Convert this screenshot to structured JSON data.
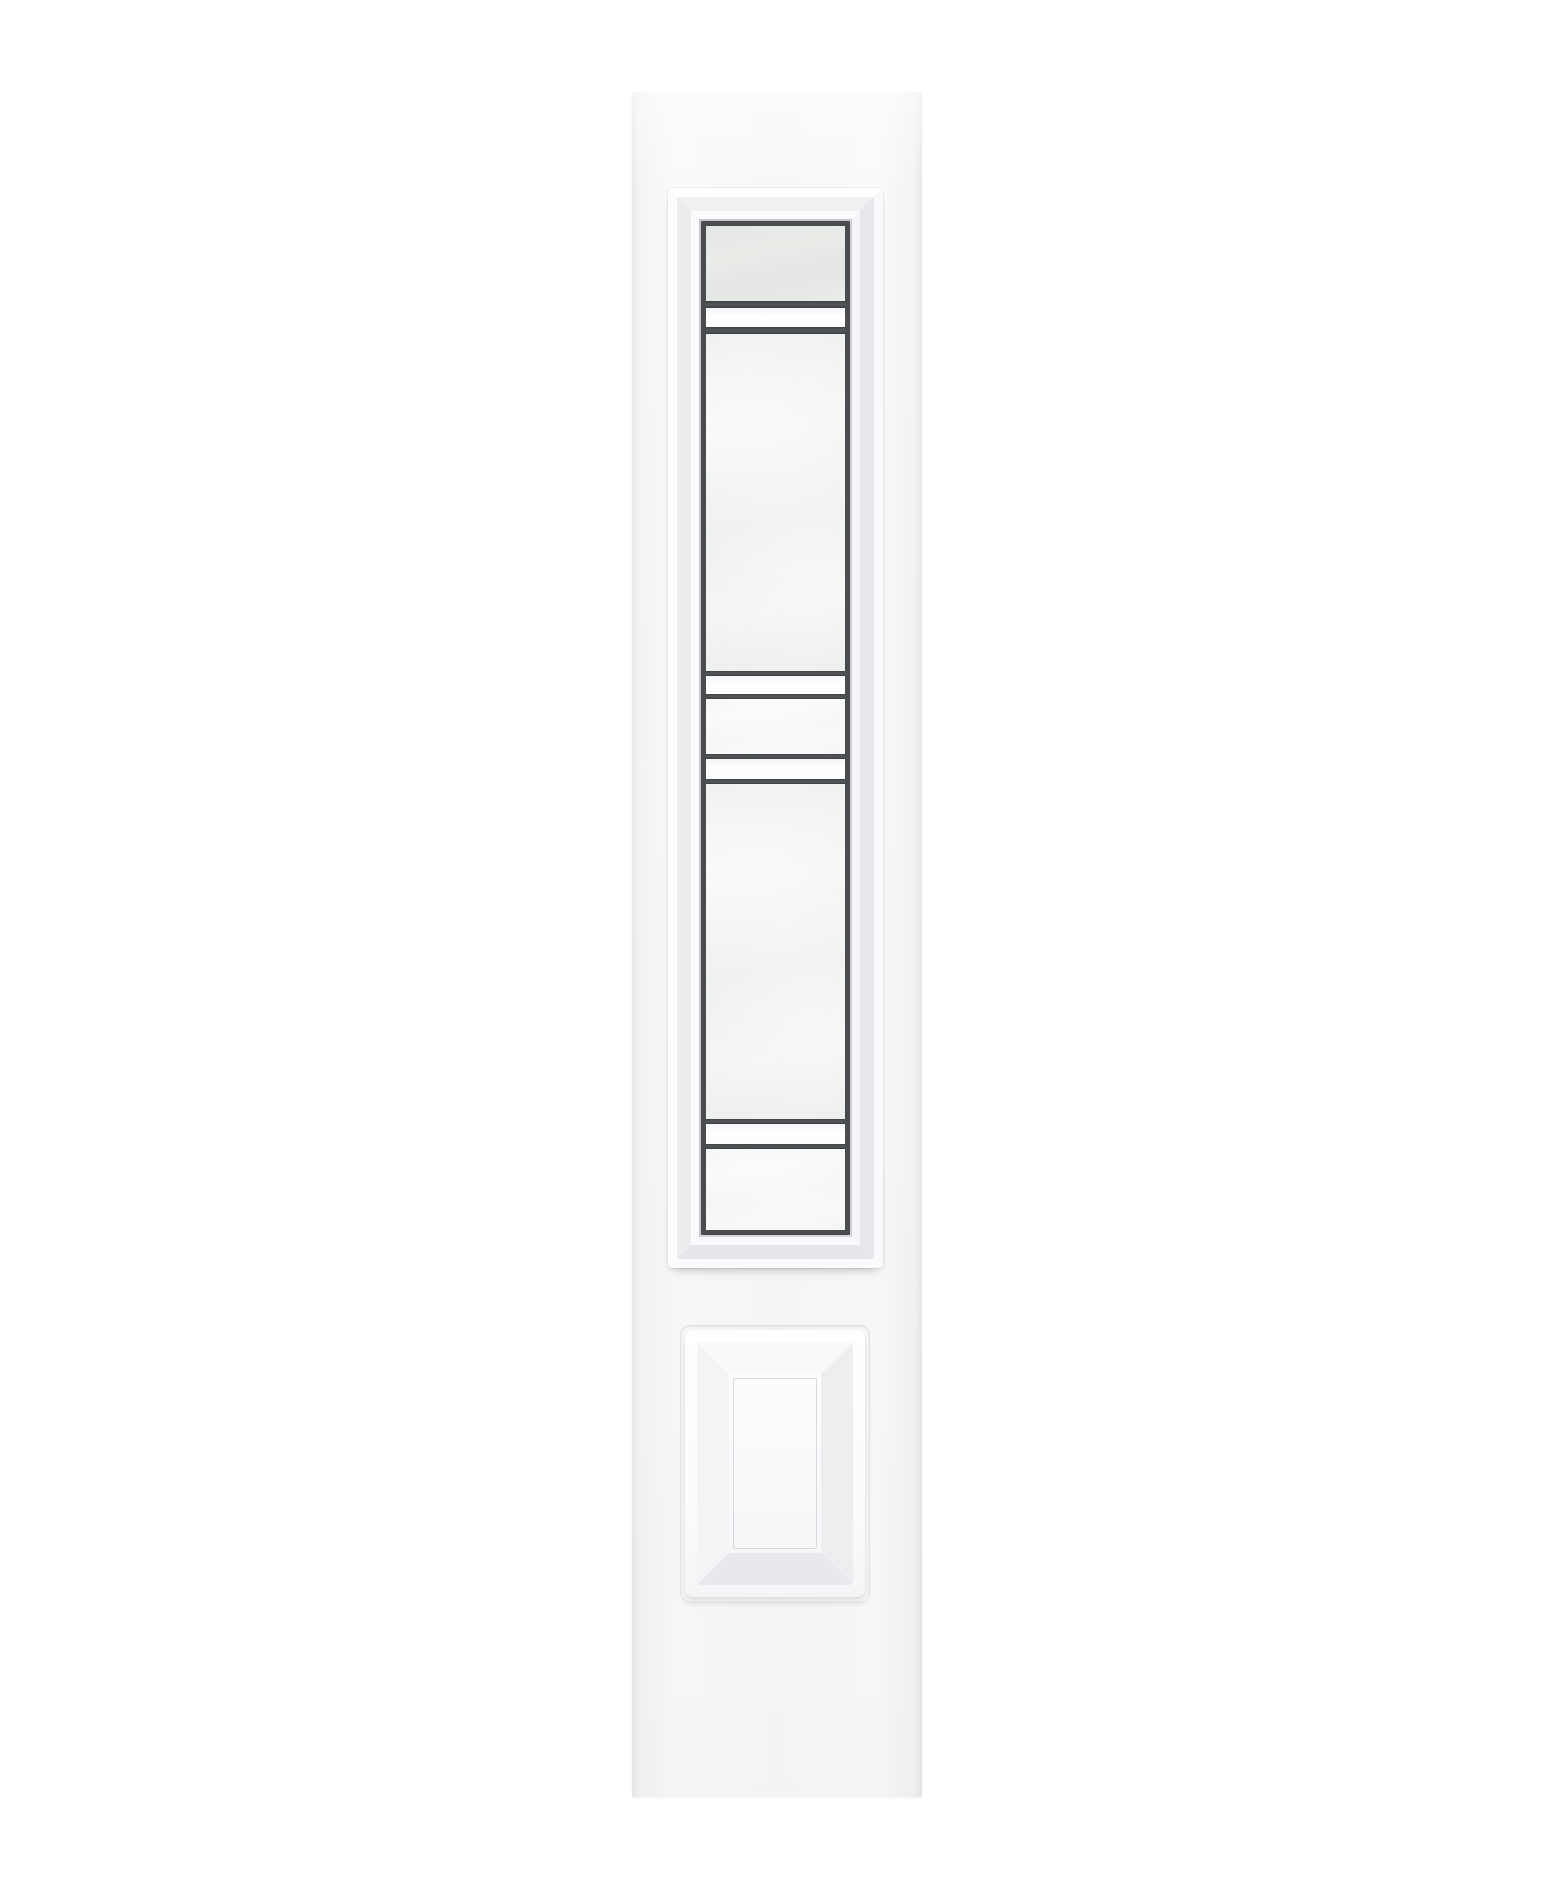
{
  "scene": {
    "type": "product-photo",
    "subject": "white sidelight door panel with decorative caming glass insert and raised bottom panel",
    "background_color": "#ffffff"
  },
  "colors": {
    "background": "#ffffff",
    "door_face": "#f8f8fa",
    "door_edge": "#e9e9ec",
    "molding_white": "#ffffff",
    "molding_shadow": "#c9c9ce",
    "caming": "#4a4d4f",
    "glass_frosted": "#f0f2f0",
    "glass_frosted_top": "#e6e8e6",
    "glass_clear": "#fefefe"
  },
  "geometry": {
    "canvas": {
      "width": 1552,
      "height": 1890
    },
    "door": {
      "x": 632,
      "y": 92,
      "width": 290,
      "height": 1705
    },
    "glass_frame": {
      "x": 668,
      "y": 188,
      "width": 215,
      "height": 1080
    },
    "bottom_panel": {
      "x": 680,
      "y": 1325,
      "width": 190,
      "height": 277
    }
  },
  "glass_insert": {
    "caming_border_px": 5,
    "sections": [
      {
        "type": "frosted_top",
        "height": 75
      },
      {
        "type": "caming",
        "height": 7
      },
      {
        "type": "clear",
        "height": 19
      },
      {
        "type": "caming",
        "height": 7
      },
      {
        "type": "frosted",
        "height": 337
      },
      {
        "type": "caming",
        "height": 5
      },
      {
        "type": "clear",
        "height": 18
      },
      {
        "type": "caming",
        "height": 5
      },
      {
        "type": "frosted",
        "height": 55
      },
      {
        "type": "caming",
        "height": 5
      },
      {
        "type": "clear",
        "height": 20
      },
      {
        "type": "caming",
        "height": 5
      },
      {
        "type": "frosted",
        "height": 335
      },
      {
        "type": "caming",
        "height": 5
      },
      {
        "type": "clear",
        "height": 20
      },
      {
        "type": "caming",
        "height": 5
      },
      {
        "type": "frosted",
        "height": 0
      }
    ]
  }
}
